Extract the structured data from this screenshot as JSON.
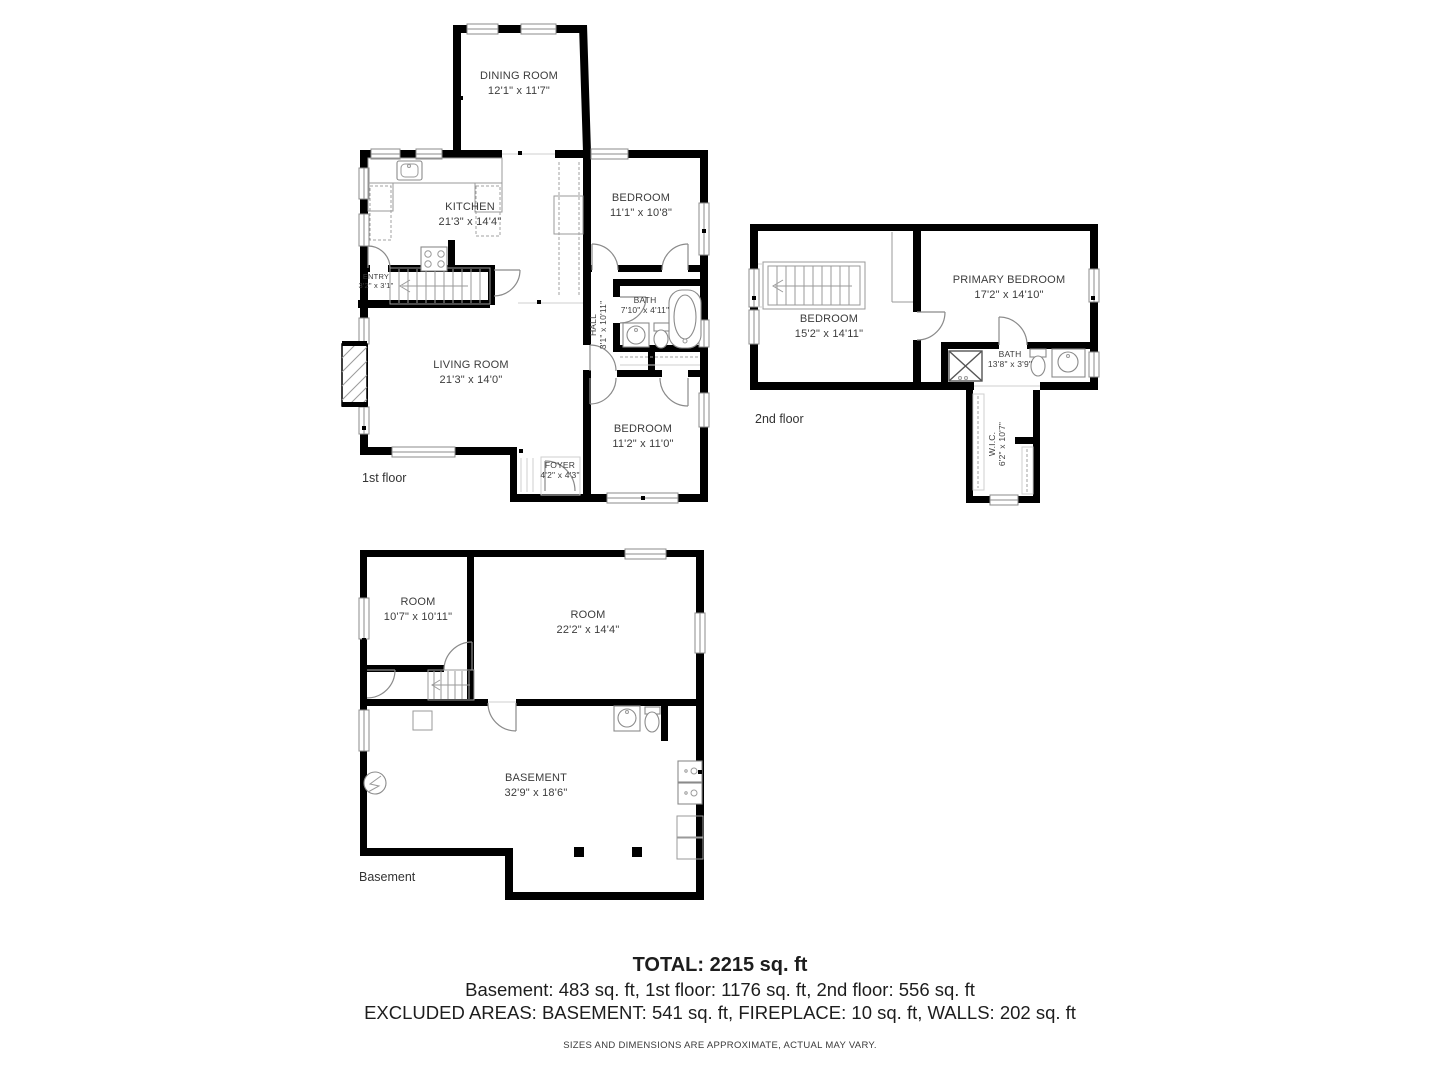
{
  "floors": {
    "first": {
      "label": "1st floor",
      "rooms": {
        "dining": {
          "name": "DINING ROOM",
          "dims": "12'1\" x 11'7\""
        },
        "kitchen": {
          "name": "KITCHEN",
          "dims": "21'3\" x 14'4\""
        },
        "bedroom_top": {
          "name": "BEDROOM",
          "dims": "11'1\" x 10'8\""
        },
        "entry": {
          "name": "ENTRY",
          "dims": "3'2\" x 3'1\""
        },
        "bath": {
          "name": "BATH",
          "dims": "7'10\" x 4'11\""
        },
        "hall": {
          "name": "HALL",
          "dims": "3'1\" x 10'11\""
        },
        "living": {
          "name": "LIVING ROOM",
          "dims": "21'3\" x 14'0\""
        },
        "foyer": {
          "name": "FOYER",
          "dims": "4'2\" x 4'3\""
        },
        "bedroom_bottom": {
          "name": "BEDROOM",
          "dims": "11'2\" x 11'0\""
        }
      }
    },
    "second": {
      "label": "2nd floor",
      "rooms": {
        "bedroom": {
          "name": "BEDROOM",
          "dims": "15'2\" x 14'11\""
        },
        "primary": {
          "name": "PRIMARY BEDROOM",
          "dims": "17'2\" x 14'10\""
        },
        "bath": {
          "name": "BATH",
          "dims": "13'8\" x 3'9\""
        },
        "wic": {
          "name": "W.I.C.",
          "dims": "6'2\" x 10'7\""
        }
      }
    },
    "basement": {
      "label": "Basement",
      "rooms": {
        "room_small": {
          "name": "ROOM",
          "dims": "10'7\" x 10'11\""
        },
        "room_large": {
          "name": "ROOM",
          "dims": "22'2\" x 14'4\""
        },
        "main": {
          "name": "BASEMENT",
          "dims": "32'9\" x 18'6\""
        }
      }
    }
  },
  "summary": {
    "total": "TOTAL: 2215 sq. ft",
    "floors_line": "Basement: 483 sq. ft, 1st floor: 1176 sq. ft, 2nd floor: 556 sq. ft",
    "excluded_line": "EXCLUDED AREAS: BASEMENT: 541 sq. ft, FIREPLACE: 10 sq. ft, WALLS: 202 sq. ft",
    "disclaimer": "SIZES AND DIMENSIONS ARE APPROXIMATE, ACTUAL MAY VARY."
  }
}
